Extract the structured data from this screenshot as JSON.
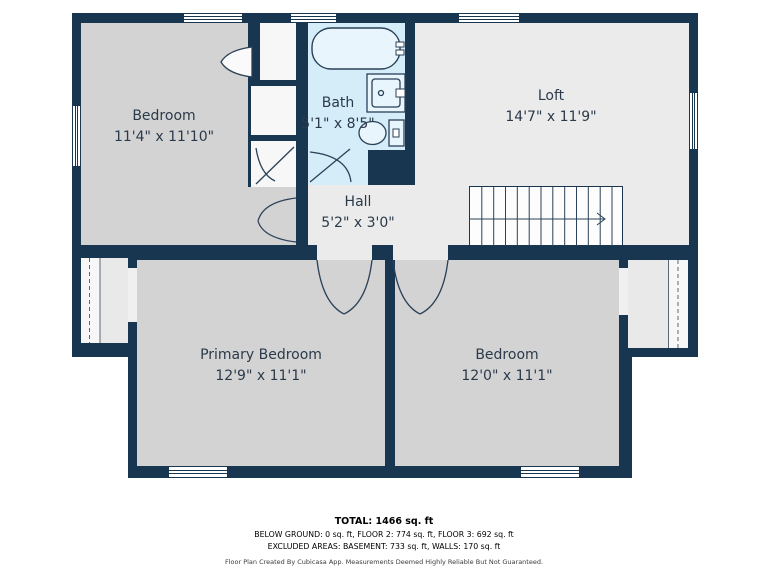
{
  "rooms": {
    "bedroom_upper": {
      "name": "Bedroom",
      "dims": "11'4\" x 11'10\""
    },
    "bath": {
      "name": "Bath",
      "dims": "5'1\" x 8'5\""
    },
    "loft": {
      "name": "Loft",
      "dims": "14'7\" x 11'9\""
    },
    "hall": {
      "name": "Hall",
      "dims": "5'2\" x 3'0\""
    },
    "primary_bedroom": {
      "name": "Primary Bedroom",
      "dims": "12'9\" x 11'1\""
    },
    "bedroom_lower": {
      "name": "Bedroom",
      "dims": "12'0\" x 11'1\""
    }
  },
  "footer": {
    "total": "TOTAL: 1466 sq. ft",
    "areas_line": "BELOW GROUND: 0 sq. ft, FLOOR 2: 774 sq. ft, FLOOR 3: 692 sq. ft",
    "excluded_line": "EXCLUDED AREAS: BASEMENT: 733 sq. ft, WALLS: 170 sq. ft",
    "disclaimer": "Floor Plan Created By Cubicasa App. Measurements Deemed Highly Reliable But Not Guaranteed."
  },
  "colors": {
    "wall": "#183650",
    "bedroom_floor": "#d3d3d3",
    "common_floor": "#ebebeb",
    "closet_floor": "#f7f7f7",
    "bath_floor": "#d5ecf9",
    "fixture_fill": "#e9f5fd",
    "label_text": "#2b3a4a"
  }
}
